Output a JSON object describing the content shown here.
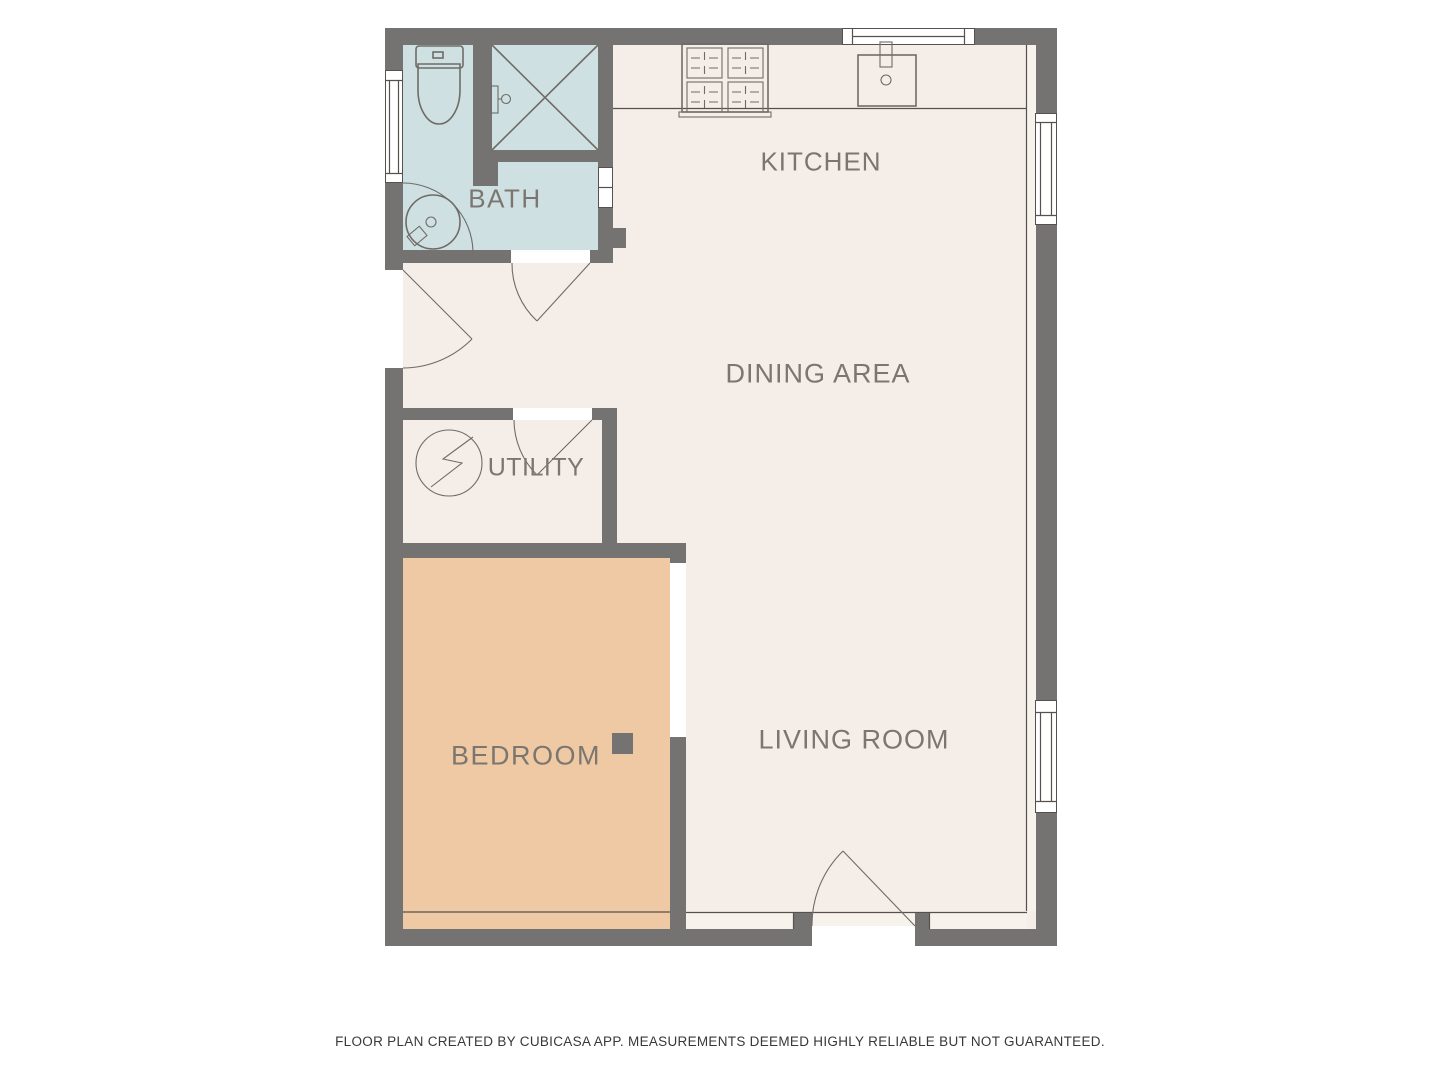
{
  "rooms": {
    "bath": {
      "label": "BATH"
    },
    "kitchen": {
      "label": "KITCHEN"
    },
    "dining": {
      "label": "DINING AREA"
    },
    "utility": {
      "label": "UTILITY"
    },
    "bedroom": {
      "label": "BEDROOM"
    },
    "living": {
      "label": "LIVING ROOM"
    }
  },
  "footer": {
    "text": "FLOOR PLAN CREATED BY CUBICASA APP. MEASUREMENTS DEEMED HIGHLY RELIABLE BUT NOT GUARANTEED."
  },
  "colors": {
    "wall": "#757272",
    "floor": "#f4ede8",
    "floor_light": "#f8f2ed",
    "bath": "#cfe0e2",
    "bedroom": "#eec9a4",
    "label": "#7b766f",
    "line": "#56514c",
    "fixture": "#6f6c66",
    "footer": "#3a3836",
    "background": "#ffffff"
  },
  "icons": {
    "toilet": "toilet-icon",
    "shower": "shower-icon",
    "round_sink": "round-sink-icon",
    "kitchen_sink": "kitchen-sink-icon",
    "stove": "stove-icon",
    "electrical_panel": "electrical-panel-icon",
    "column": "column-marker"
  }
}
